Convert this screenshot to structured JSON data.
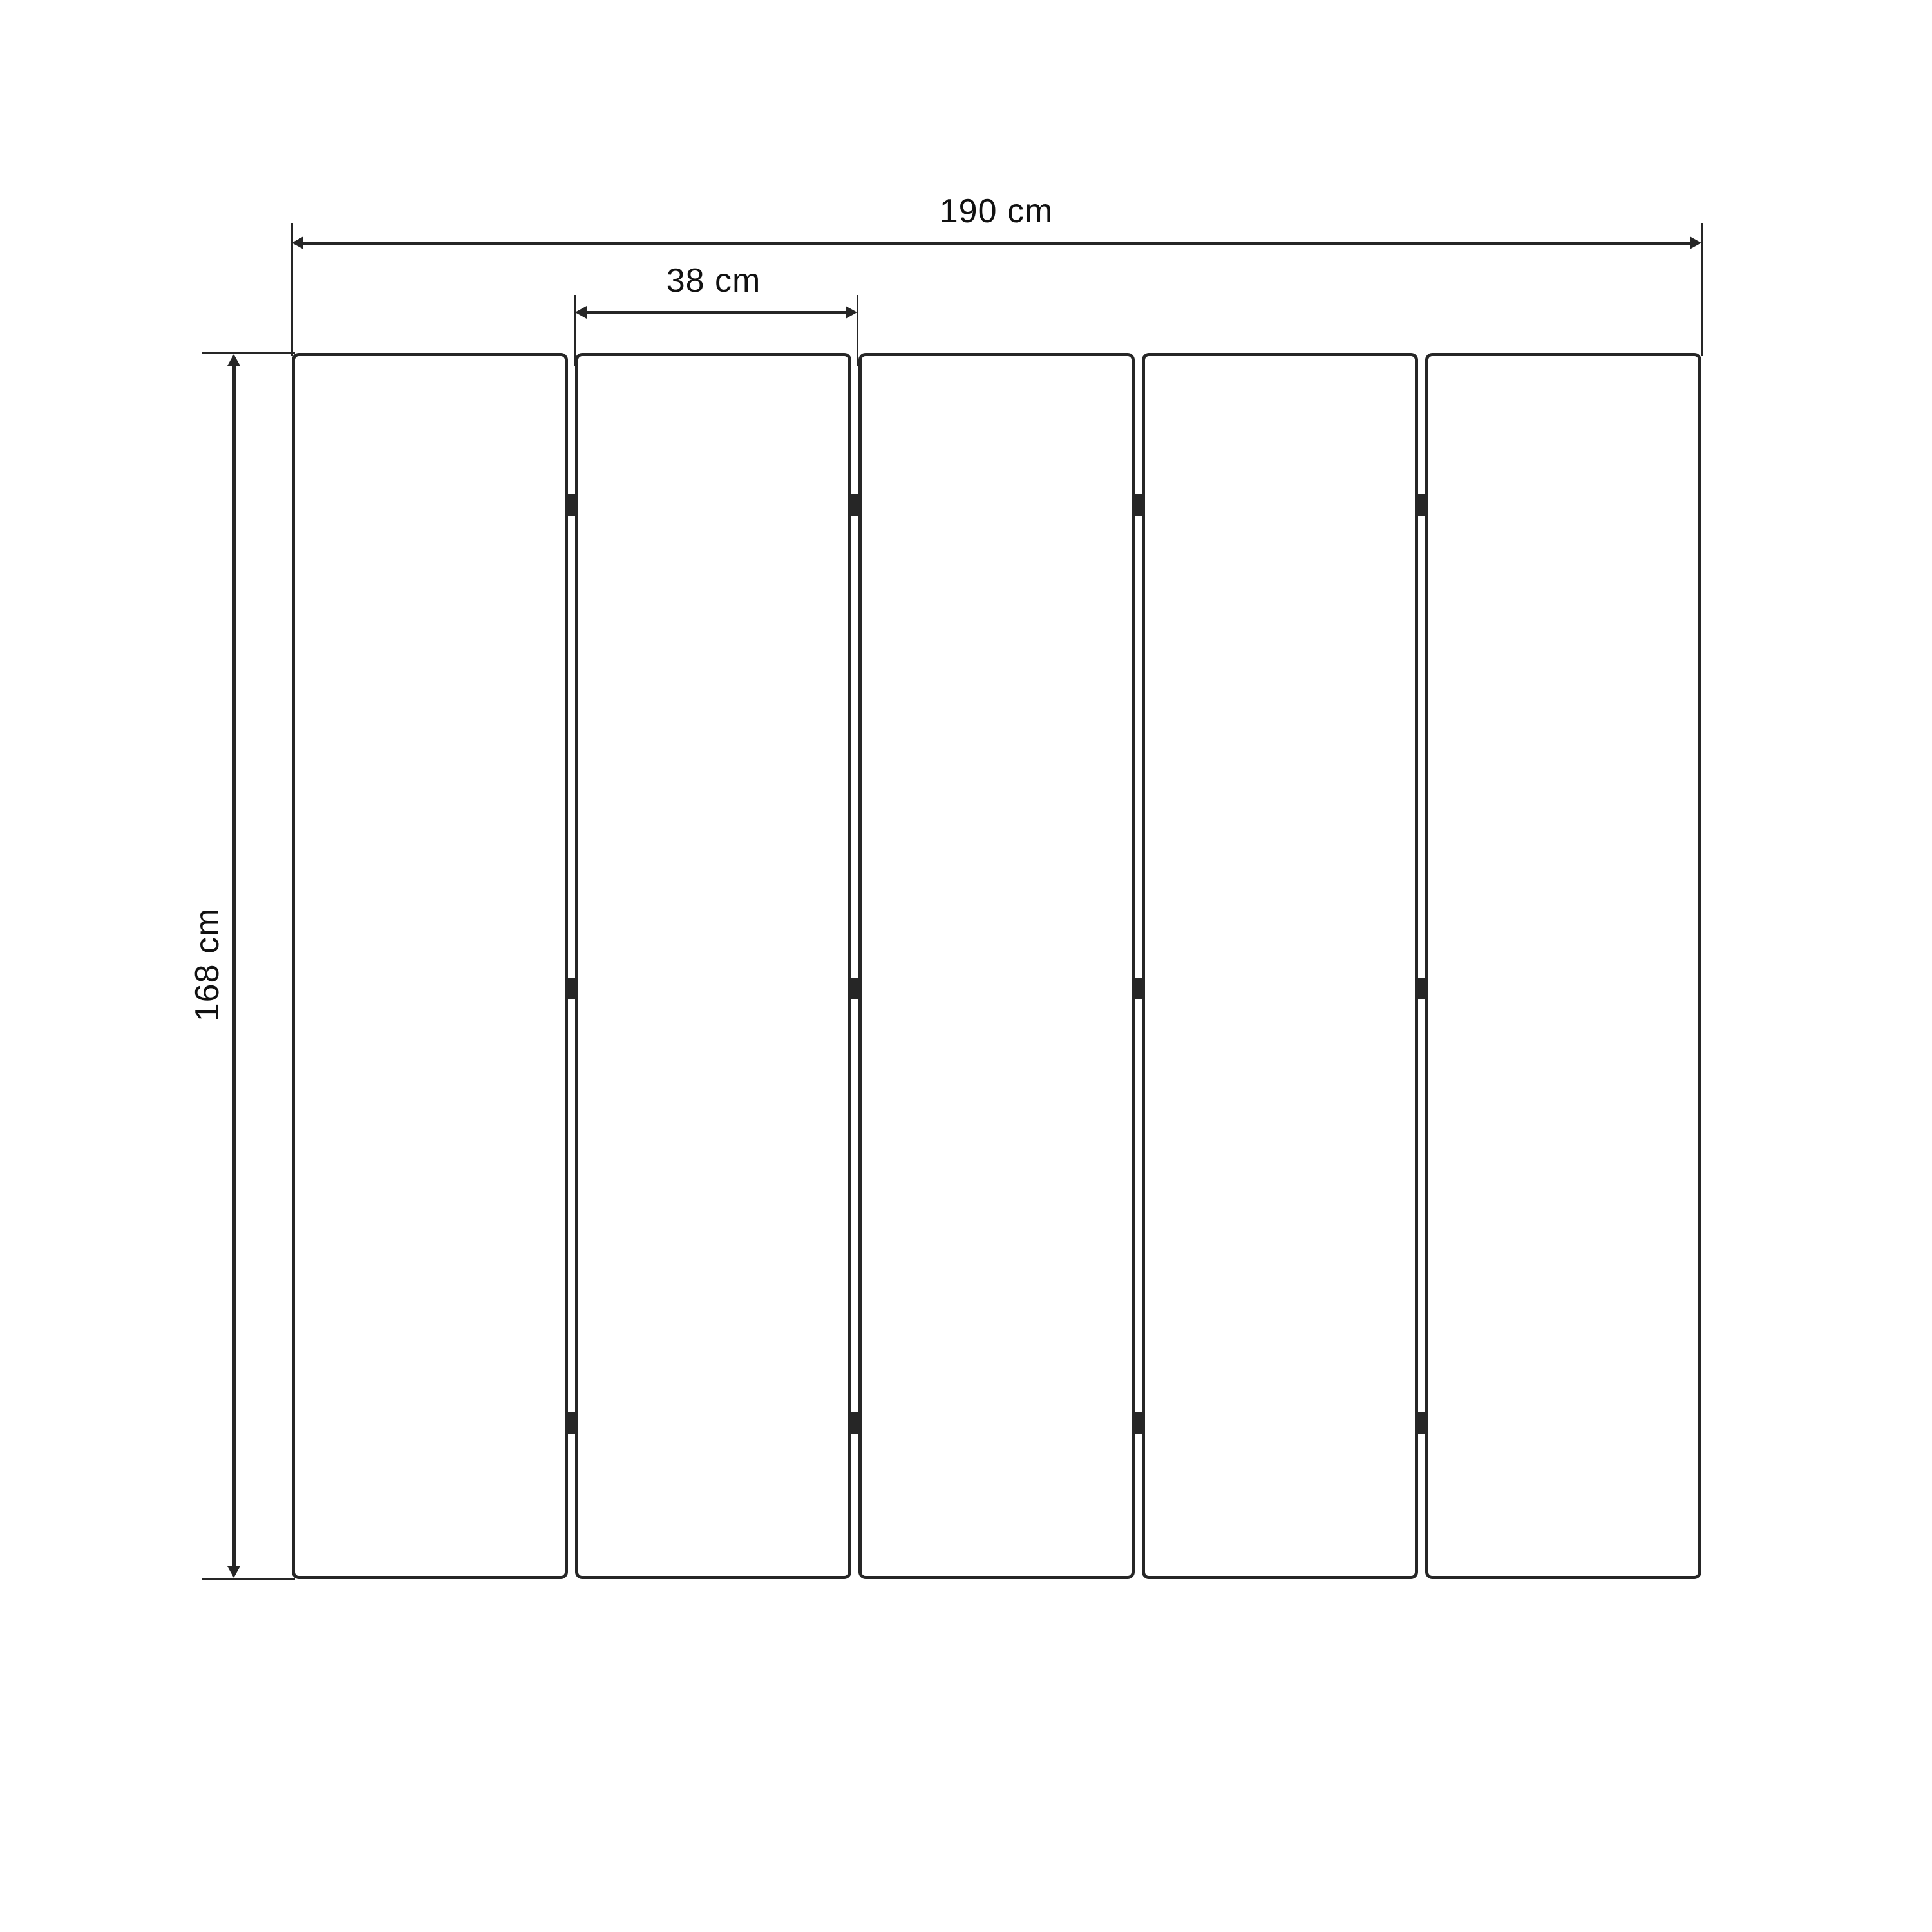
{
  "dimensions": {
    "total_width": {
      "label": "190 cm",
      "value": 190,
      "unit": "cm"
    },
    "panel_width": {
      "label": "38 cm",
      "value": 38,
      "unit": "cm"
    },
    "height": {
      "label": "168 cm",
      "value": 168,
      "unit": "cm"
    }
  },
  "panels": {
    "count": 5,
    "hinges_per_gap": 3
  },
  "colors": {
    "line": "#262626",
    "background": "#ffffff"
  }
}
